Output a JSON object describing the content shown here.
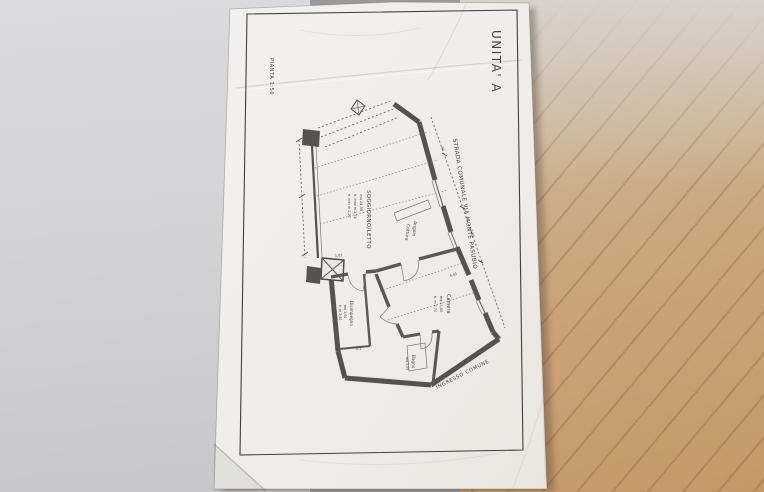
{
  "sheet": {
    "plan_title": "PIANTA  1:50",
    "unit_title": "UNITA' A"
  },
  "plan": {
    "rooms": [
      {
        "name": "SOGGIORNO/LETTO",
        "area": "mq 24,50",
        "height_max": "h. max m 2,74",
        "height_min": "h. min m 2,20"
      },
      {
        "name": "Angolo",
        "name2": "Cottura"
      },
      {
        "name": "Disimpegno",
        "area": "mq 1,90",
        "height": "h. m 2,40"
      },
      {
        "name": "Camera",
        "area": "mq 11,80",
        "height": "h. m 2,70"
      },
      {
        "name": "Bagno",
        "area": "mq 3,95"
      }
    ],
    "annotations": {
      "street": "STRADA COMUNALE VIA MONTE PASUBIO",
      "entrance": "INGRESSO COMUNE"
    },
    "dimensions": {
      "interior_wall": "1,02",
      "hall_width": "2,1",
      "step": "60",
      "camera_diag": "4,45",
      "right_upper": "95",
      "right_lower": "3,85"
    }
  },
  "colors": {
    "paper": "#f1efec",
    "ink": "#4a4745",
    "wall": "#56524e",
    "wood_floor": "#c79d6f",
    "gray_floor": "#d6d5d7"
  }
}
